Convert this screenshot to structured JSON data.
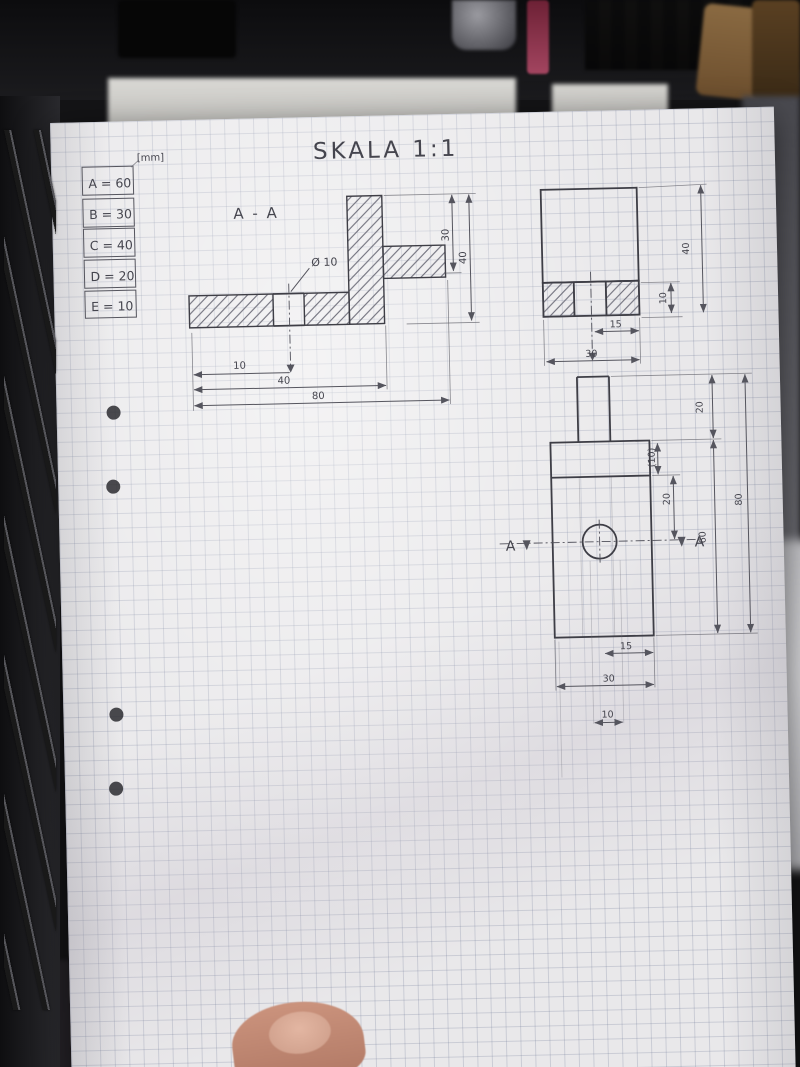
{
  "notebook": {
    "title": "SKALA 1:1",
    "unit": "[mm]",
    "legend": {
      "rows": [
        "A = 60",
        "B = 30",
        "C = 40",
        "D = 20",
        "E = 10"
      ]
    },
    "section_view": {
      "name": "A - A",
      "hole": "Ø 10",
      "dim_right_inner": "30",
      "dim_right_outer": "40",
      "dim_bottom_inner": "10",
      "dim_bottom_mid": "40",
      "dim_bottom_outer": "80"
    },
    "side_view": {
      "dim_thickness": "10",
      "dim_height": "40",
      "dim_hole_to_edge": "15",
      "dim_width": "30"
    },
    "front_view": {
      "cut_label_left": "A",
      "cut_label_right": "A",
      "dim_stem": "20",
      "dim_collar_ref": "(10)",
      "dim_hole_center": "20",
      "dim_body": "60",
      "dim_total": "80",
      "dim_hole_to_edge": "15",
      "dim_width": "30",
      "dim_hole": "10"
    }
  }
}
